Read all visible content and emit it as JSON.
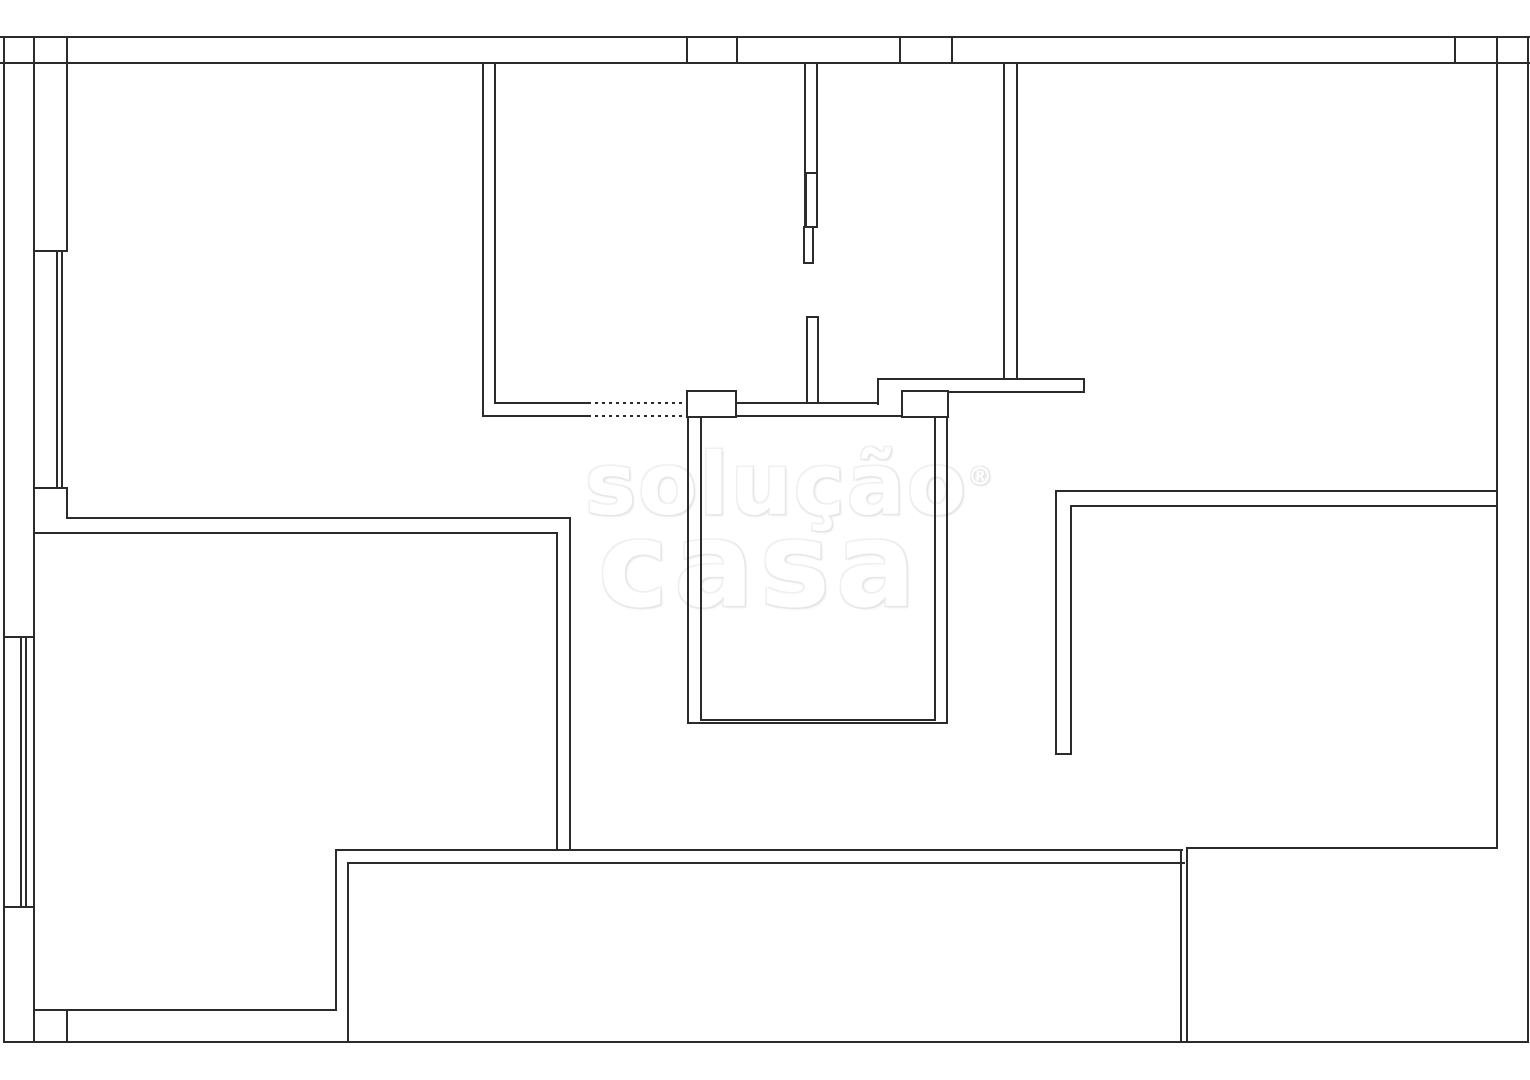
{
  "canvas": {
    "width": 1530,
    "height": 1080,
    "background": "#ffffff",
    "line_color": "#2b2b2b"
  },
  "watermark": {
    "line1": "solução",
    "reg": "®",
    "line2": "casa",
    "fill": "#ffffff",
    "outline": "#e9e9e9"
  },
  "plan": {
    "segments": [
      [
        0,
        36,
        1530,
        2
      ],
      [
        0,
        62,
        1530,
        2
      ],
      [
        3,
        36,
        2,
        1007
      ],
      [
        33,
        36,
        2,
        1007
      ],
      [
        66,
        36,
        2,
        214
      ],
      [
        66,
        488,
        2,
        31
      ],
      [
        66,
        1009,
        2,
        34
      ],
      [
        686,
        36,
        2,
        28
      ],
      [
        736,
        36,
        2,
        28
      ],
      [
        899,
        36,
        2,
        28
      ],
      [
        951,
        36,
        2,
        28
      ],
      [
        1454,
        36,
        2,
        28
      ],
      [
        1496,
        36,
        2,
        813
      ],
      [
        1527,
        36,
        2,
        1007
      ],
      [
        33,
        250,
        35,
        2
      ],
      [
        33,
        487,
        35,
        2
      ],
      [
        56,
        252,
        2,
        235
      ],
      [
        61,
        252,
        2,
        235
      ],
      [
        3,
        636,
        32,
        2
      ],
      [
        3,
        906,
        32,
        2
      ],
      [
        20,
        638,
        2,
        268
      ],
      [
        25,
        638,
        2,
        268
      ],
      [
        66,
        517,
        504,
        2
      ],
      [
        33,
        532,
        524,
        2
      ],
      [
        556,
        532,
        2,
        318
      ],
      [
        569,
        517,
        2,
        334
      ],
      [
        335,
        849,
        848,
        2
      ],
      [
        348,
        862,
        837,
        2
      ],
      [
        335,
        849,
        2,
        161
      ],
      [
        347,
        862,
        2,
        181
      ],
      [
        33,
        1009,
        304,
        2
      ],
      [
        3,
        1041,
        1525,
        2
      ],
      [
        1180,
        849,
        2,
        194
      ],
      [
        1186,
        849,
        2,
        194
      ],
      [
        1186,
        847,
        312,
        2
      ],
      [
        1055,
        490,
        442,
        2
      ],
      [
        1072,
        505,
        426,
        2
      ],
      [
        1055,
        490,
        2,
        265
      ],
      [
        1070,
        505,
        2,
        250
      ],
      [
        1055,
        753,
        17,
        2
      ],
      [
        877,
        378,
        208,
        2
      ],
      [
        948,
        391,
        137,
        2
      ],
      [
        1083,
        378,
        2,
        15
      ],
      [
        877,
        378,
        2,
        27
      ],
      [
        1003,
        64,
        2,
        315
      ],
      [
        1016,
        64,
        2,
        315
      ],
      [
        482,
        64,
        2,
        353
      ],
      [
        494,
        64,
        2,
        340
      ],
      [
        494,
        402,
        94,
        2
      ],
      [
        482,
        415,
        106,
        2
      ],
      [
        736,
        402,
        142,
        2
      ],
      [
        736,
        415,
        166,
        2
      ],
      [
        804,
        64,
        2,
        164
      ],
      [
        816,
        64,
        2,
        164
      ],
      [
        687,
        417,
        2,
        307
      ],
      [
        700,
        417,
        2,
        304
      ],
      [
        934,
        417,
        2,
        304
      ],
      [
        946,
        417,
        2,
        307
      ],
      [
        700,
        719,
        236,
        2
      ],
      [
        687,
        722,
        261,
        2
      ]
    ],
    "dotted_segments": [
      [
        588,
        402,
        99,
        2
      ],
      [
        588,
        415,
        99,
        2
      ]
    ],
    "boxes": [
      [
        686,
        390,
        51,
        28
      ],
      [
        901,
        390,
        48,
        28
      ],
      [
        806,
        316,
        13,
        88
      ],
      [
        805,
        172,
        13,
        56
      ],
      [
        803,
        226,
        11,
        38
      ]
    ]
  }
}
